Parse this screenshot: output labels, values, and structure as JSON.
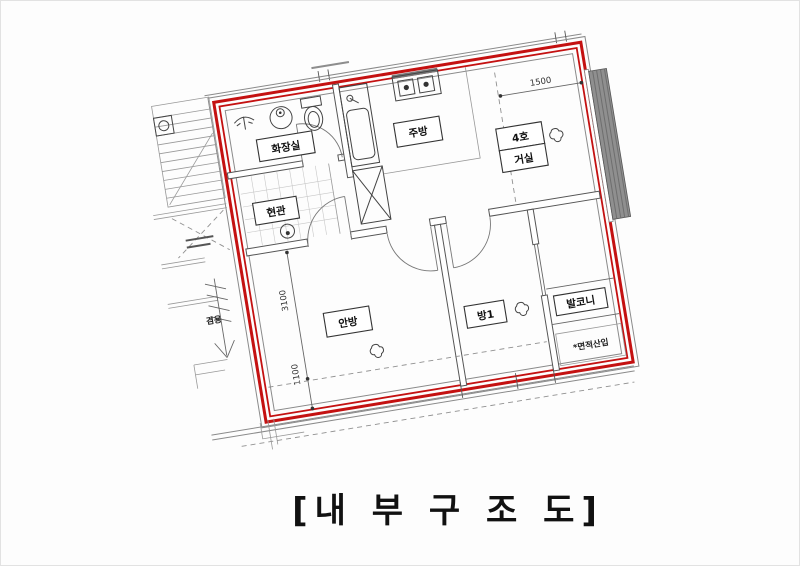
{
  "caption": "[내 부 구 조 도]",
  "plan": {
    "rooms": {
      "bathroom": "화장실",
      "entrance": "현관",
      "kitchen": "주방",
      "unit_no": "4호",
      "living": "거실",
      "master": "안방",
      "room1": "방1",
      "balcony": "발코니"
    },
    "notes": {
      "area_note": "*면적산입",
      "shared": "겸용"
    },
    "dims": {
      "d1500": "1500",
      "d3100": "3100",
      "d1100": "1100"
    },
    "colors": {
      "boundary_red": "#c41111",
      "wall_gray": "#555555",
      "dash_gray": "#909090"
    }
  }
}
